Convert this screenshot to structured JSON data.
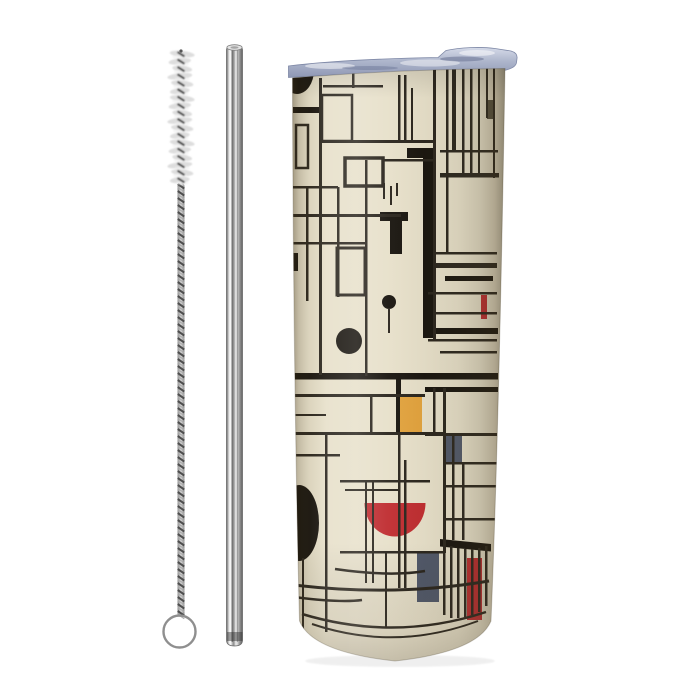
{
  "scene": {
    "description": "Product photo: skinny tumbler with abstract De Stijl grid artwork, straw cleaning brush and stainless steel straw on white background",
    "background": "#ffffff"
  },
  "palette": {
    "ink": "#29241c",
    "ink2": "#55503f",
    "black": "#17130d",
    "red": "#bf2b2f",
    "yellow": "#e2a23c",
    "slate": "#4f5769",
    "cream": "#e7e0ca",
    "lid_blue": "#aeb6cc",
    "metal_light": "#f2f2f2",
    "metal_mid": "#9e9e9e",
    "metal_dark": "#5f5f5f",
    "bristle": "#d7d7d7",
    "wire": "#4a4a4a"
  },
  "brush": {
    "cx": 181,
    "bristle_top": 54,
    "bristle_bottom": 180,
    "bristle_rx": 12.5,
    "rows": 18,
    "stem_x": 177.5,
    "stem_w": 7,
    "stem_top": 183,
    "stem_bottom": 615,
    "loop_cx": 179.5,
    "loop_cy": 631.5,
    "loop_r": 16
  },
  "straw": {
    "tube_path": "M226.5 50 Q226.5 45.5 234.5 45.5 Q242.5 45.5 242.5 50 L242.5 640 Q242.5 646 234.5 646 Q226.5 646 226.5 640 Z"
  },
  "tumbler": {
    "body_path": "M292.5 78 Q395 69.5 505 68.5 C502 250 498 450 491 621 Q478 652 395 661 Q312 652 299.5 621 C294.5 420 292.8 200 292.5 78 Z",
    "lid_path": "M288.5 77.5 L288.5 66 C330 61 380 58.5 438 57.5 L446 50.5 C460 47.5 480 46.5 495 48.5 L511 51 C516 52.5 517.5 55 517 58.5 L516.5 62.5 C516 66.5 511 69 504 70.5 L503 71.5 C430 71.5 340 74 288.5 77.5 Z"
  },
  "artwork": {
    "items": [
      {
        "t": "e",
        "cx": 297,
        "cy": 70,
        "rx": 17,
        "ry": 24,
        "f": "black",
        "n": "top-left-partial-circle"
      },
      {
        "t": "r",
        "x": 293,
        "y": 107,
        "w": 26,
        "h": 6,
        "f": "black"
      },
      {
        "t": "r",
        "x": 407,
        "y": 148,
        "w": 26,
        "h": 10,
        "f": "black",
        "n": "thick-bar-top"
      },
      {
        "t": "r",
        "x": 423,
        "y": 148,
        "w": 10,
        "h": 190,
        "f": "black",
        "n": "thick-vertical-bar"
      },
      {
        "t": "r",
        "x": 380,
        "y": 212,
        "w": 28,
        "h": 9,
        "f": "black"
      },
      {
        "t": "r",
        "x": 390,
        "y": 212,
        "w": 12,
        "h": 42,
        "f": "black"
      },
      {
        "t": "r",
        "x": 428,
        "y": 328,
        "w": 70,
        "h": 6,
        "f": "black"
      },
      {
        "t": "r",
        "x": 293,
        "y": 373,
        "w": 205,
        "h": 6.5,
        "f": "black",
        "n": "thick-horizontal-band"
      },
      {
        "t": "r",
        "x": 425,
        "y": 387,
        "w": 73,
        "h": 5,
        "f": "black"
      },
      {
        "t": "r",
        "x": 396,
        "y": 375,
        "w": 5,
        "h": 60,
        "f": "black"
      },
      {
        "t": "r",
        "x": 445,
        "y": 276,
        "w": 48,
        "h": 5,
        "f": "black"
      },
      {
        "t": "r",
        "x": 291,
        "y": 253,
        "w": 7,
        "h": 18,
        "f": "black"
      },
      {
        "t": "r",
        "x": 487,
        "y": 100,
        "w": 7,
        "h": 19,
        "f": "ink2"
      },
      {
        "t": "r",
        "x": 400,
        "y": 395,
        "w": 22,
        "h": 38,
        "f": "yellow",
        "n": "yellow-rect"
      },
      {
        "t": "r",
        "x": 443,
        "y": 433,
        "w": 19,
        "h": 29,
        "f": "slate",
        "n": "slate-rect-upper"
      },
      {
        "t": "r",
        "x": 417,
        "y": 553,
        "w": 22,
        "h": 49,
        "f": "slate",
        "n": "slate-rect-lower"
      },
      {
        "t": "r",
        "x": 467,
        "y": 558,
        "w": 15,
        "h": 62,
        "f": "red",
        "n": "red-rect-bottom"
      },
      {
        "t": "r",
        "x": 481,
        "y": 295,
        "w": 6,
        "h": 24,
        "f": "red",
        "n": "small-red-bar"
      },
      {
        "t": "p",
        "d": "M364.5 503 A30.5 33.5 0 0 0 425.5 503 Z",
        "f": "red",
        "n": "red-bowl"
      },
      {
        "t": "c",
        "cx": 389,
        "cy": 302,
        "r": 7,
        "f": "black",
        "n": "small-black-dot"
      },
      {
        "t": "c",
        "cx": 349,
        "cy": 341,
        "r": 13,
        "f": "black",
        "n": "medium-black-circle"
      },
      {
        "t": "e",
        "cx": 299,
        "cy": 523,
        "rx": 20,
        "ry": 38,
        "f": "black",
        "n": "large-black-ellipse"
      },
      {
        "t": "p",
        "d": "M440 539 L491 544 L491 551.5 L440 546.5 Z",
        "f": "black",
        "n": "slanted-black-bar"
      },
      {
        "t": "r",
        "x": 319,
        "y": 78,
        "w": 3,
        "h": 297,
        "f": "ink"
      },
      {
        "t": "r",
        "x": 306,
        "y": 187,
        "w": 2.5,
        "h": 114,
        "f": "ink"
      },
      {
        "t": "r",
        "x": 337,
        "y": 187,
        "w": 2.5,
        "h": 110,
        "f": "ink"
      },
      {
        "t": "r",
        "x": 365,
        "y": 160,
        "w": 2.5,
        "h": 216,
        "f": "ink"
      },
      {
        "t": "r",
        "x": 352,
        "y": 70,
        "w": 2.5,
        "h": 18,
        "f": "ink"
      },
      {
        "t": "r",
        "x": 398,
        "y": 75,
        "w": 2.5,
        "h": 68,
        "f": "ink"
      },
      {
        "t": "r",
        "x": 404,
        "y": 75,
        "w": 2.5,
        "h": 68,
        "f": "ink"
      },
      {
        "t": "r",
        "x": 411,
        "y": 88,
        "w": 2,
        "h": 54,
        "f": "ink"
      },
      {
        "t": "r",
        "x": 433,
        "y": 69,
        "w": 3,
        "h": 272,
        "f": "ink"
      },
      {
        "t": "r",
        "x": 446,
        "y": 66,
        "w": 2.5,
        "h": 188,
        "f": "ink"
      },
      {
        "t": "r",
        "x": 452,
        "y": 69,
        "w": 4,
        "h": 83,
        "f": "ink"
      },
      {
        "t": "r",
        "x": 462,
        "y": 69,
        "w": 2.5,
        "h": 108,
        "f": "ink"
      },
      {
        "t": "r",
        "x": 470,
        "y": 66,
        "w": 2.5,
        "h": 111,
        "f": "ink"
      },
      {
        "t": "r",
        "x": 478,
        "y": 66,
        "w": 2,
        "h": 111,
        "f": "ink"
      },
      {
        "t": "r",
        "x": 486,
        "y": 66,
        "w": 2,
        "h": 52,
        "f": "ink"
      },
      {
        "t": "r",
        "x": 493,
        "y": 66,
        "w": 2,
        "h": 112,
        "f": "ink"
      },
      {
        "t": "r",
        "x": 323,
        "y": 85,
        "w": 60,
        "h": 2.5,
        "f": "ink"
      },
      {
        "t": "r",
        "x": 322,
        "y": 140,
        "w": 112,
        "h": 3,
        "f": "ink"
      },
      {
        "t": "r",
        "x": 383,
        "y": 159,
        "w": 50,
        "h": 2.5,
        "f": "ink"
      },
      {
        "t": "r",
        "x": 440,
        "y": 150,
        "w": 58,
        "h": 2.5,
        "f": "ink"
      },
      {
        "t": "r",
        "x": 440,
        "y": 173,
        "w": 59,
        "h": 4.5,
        "f": "ink"
      },
      {
        "t": "r",
        "x": 293,
        "y": 186,
        "w": 45,
        "h": 2.5,
        "f": "ink"
      },
      {
        "t": "r",
        "x": 293,
        "y": 214,
        "w": 108,
        "h": 3,
        "f": "ink"
      },
      {
        "t": "r",
        "x": 293,
        "y": 242,
        "w": 73,
        "h": 2.5,
        "f": "ink"
      },
      {
        "t": "r",
        "x": 433,
        "y": 252,
        "w": 64,
        "h": 2.5,
        "f": "ink"
      },
      {
        "t": "r",
        "x": 433,
        "y": 263,
        "w": 64,
        "h": 5,
        "f": "ink"
      },
      {
        "t": "r",
        "x": 428,
        "y": 292,
        "w": 69,
        "h": 2.5,
        "f": "ink"
      },
      {
        "t": "r",
        "x": 433,
        "y": 312,
        "w": 64,
        "h": 2.5,
        "f": "ink"
      },
      {
        "t": "r",
        "x": 428,
        "y": 339,
        "w": 69,
        "h": 2.5,
        "f": "ink"
      },
      {
        "t": "r",
        "x": 440,
        "y": 351,
        "w": 57,
        "h": 2.5,
        "f": "ink"
      },
      {
        "t": "o",
        "x": 322,
        "y": 95,
        "w": 30,
        "h": 46,
        "sw": 2.5,
        "f": "ink"
      },
      {
        "t": "o",
        "x": 296,
        "y": 125,
        "w": 12,
        "h": 43,
        "sw": 2.5,
        "f": "ink"
      },
      {
        "t": "o",
        "x": 345,
        "y": 158,
        "w": 38,
        "h": 28,
        "sw": 3.5,
        "f": "ink"
      },
      {
        "t": "o",
        "x": 337,
        "y": 248,
        "w": 28,
        "h": 47,
        "sw": 3,
        "f": "ink"
      },
      {
        "t": "r",
        "x": 383,
        "y": 183,
        "w": 2,
        "h": 16,
        "f": "ink"
      },
      {
        "t": "r",
        "x": 390,
        "y": 186,
        "w": 2,
        "h": 19,
        "f": "ink"
      },
      {
        "t": "r",
        "x": 396,
        "y": 183,
        "w": 2,
        "h": 13,
        "f": "ink"
      },
      {
        "t": "r",
        "x": 388,
        "y": 308,
        "w": 2,
        "h": 25,
        "f": "ink"
      },
      {
        "t": "r",
        "x": 293,
        "y": 394,
        "w": 132,
        "h": 3,
        "f": "ink"
      },
      {
        "t": "r",
        "x": 293,
        "y": 414,
        "w": 33,
        "h": 2,
        "f": "ink"
      },
      {
        "t": "r",
        "x": 293,
        "y": 432,
        "w": 150,
        "h": 3,
        "f": "ink"
      },
      {
        "t": "r",
        "x": 370,
        "y": 394,
        "w": 2.5,
        "h": 40,
        "f": "ink"
      },
      {
        "t": "r",
        "x": 398,
        "y": 435,
        "w": 2.5,
        "h": 153,
        "f": "ink"
      },
      {
        "t": "r",
        "x": 404,
        "y": 460,
        "w": 2.5,
        "h": 128,
        "f": "ink"
      },
      {
        "t": "r",
        "x": 325,
        "y": 432,
        "w": 2.5,
        "h": 200,
        "f": "ink"
      },
      {
        "t": "r",
        "x": 302,
        "y": 558,
        "w": 2,
        "h": 72,
        "f": "ink"
      },
      {
        "t": "r",
        "x": 385,
        "y": 553,
        "w": 2,
        "h": 75,
        "f": "ink"
      },
      {
        "t": "r",
        "x": 443,
        "y": 388,
        "w": 3,
        "h": 165,
        "f": "ink"
      },
      {
        "t": "r",
        "x": 452,
        "y": 433,
        "w": 2.5,
        "h": 107,
        "f": "ink"
      },
      {
        "t": "r",
        "x": 462,
        "y": 462,
        "w": 2.5,
        "h": 78,
        "f": "ink"
      },
      {
        "t": "r",
        "x": 433,
        "y": 388,
        "w": 2.5,
        "h": 45,
        "f": "ink"
      },
      {
        "t": "r",
        "x": 425,
        "y": 433,
        "w": 72,
        "h": 3,
        "f": "ink"
      },
      {
        "t": "r",
        "x": 443,
        "y": 462,
        "w": 54,
        "h": 2.5,
        "f": "ink"
      },
      {
        "t": "r",
        "x": 443,
        "y": 485,
        "w": 54,
        "h": 2.5,
        "f": "ink"
      },
      {
        "t": "r",
        "x": 443,
        "y": 518,
        "w": 54,
        "h": 2.5,
        "f": "ink"
      },
      {
        "t": "r",
        "x": 340,
        "y": 480,
        "w": 90,
        "h": 2.5,
        "f": "ink"
      },
      {
        "t": "r",
        "x": 345,
        "y": 489,
        "w": 55,
        "h": 2,
        "f": "ink"
      },
      {
        "t": "r",
        "x": 293,
        "y": 454,
        "w": 47,
        "h": 2.5,
        "f": "ink"
      },
      {
        "t": "r",
        "x": 365,
        "y": 480,
        "w": 2,
        "h": 103,
        "f": "ink"
      },
      {
        "t": "r",
        "x": 372,
        "y": 480,
        "w": 2,
        "h": 103,
        "f": "ink"
      },
      {
        "t": "r",
        "x": 340,
        "y": 551,
        "w": 104,
        "h": 2.5,
        "f": "ink"
      },
      {
        "t": "r",
        "x": 443,
        "y": 540,
        "w": 2.5,
        "h": 75,
        "f": "ink"
      },
      {
        "t": "r",
        "x": 450,
        "y": 546,
        "w": 2.5,
        "h": 72,
        "f": "ink"
      },
      {
        "t": "r",
        "x": 457,
        "y": 548,
        "w": 2.5,
        "h": 70,
        "f": "ink"
      },
      {
        "t": "r",
        "x": 464,
        "y": 549,
        "w": 2.5,
        "h": 68,
        "f": "ink"
      },
      {
        "t": "r",
        "x": 471,
        "y": 549,
        "w": 2.5,
        "h": 66,
        "f": "ink"
      },
      {
        "t": "r",
        "x": 478,
        "y": 548,
        "w": 2.5,
        "h": 64,
        "f": "ink"
      },
      {
        "t": "r",
        "x": 485,
        "y": 546,
        "w": 2.5,
        "h": 60,
        "f": "ink"
      },
      {
        "t": "s",
        "d": "M335 569 Q390 577 425 571",
        "sw": 2.5,
        "f": "ink"
      },
      {
        "t": "s",
        "d": "M294 585 Q395 597 489 581",
        "sw": 3,
        "f": "ink"
      },
      {
        "t": "s",
        "d": "M294 597 Q340 603 362 600",
        "sw": 2.5,
        "f": "ink"
      },
      {
        "t": "s",
        "d": "M302 614 Q395 642 486 612",
        "sw": 2.5,
        "f": "ink"
      },
      {
        "t": "s",
        "d": "M312 624 Q395 652 478 621",
        "sw": 2,
        "f": "ink"
      }
    ]
  }
}
